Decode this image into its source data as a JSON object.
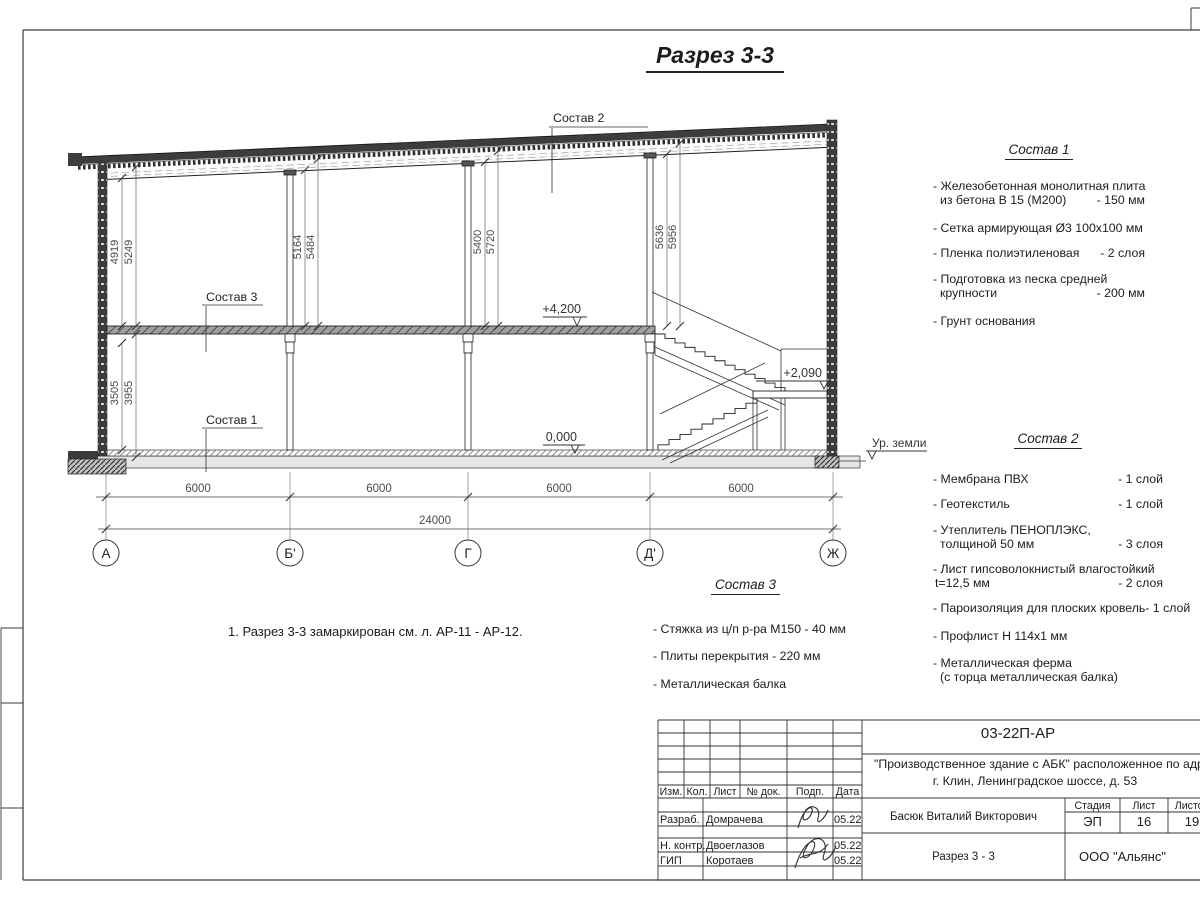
{
  "page": {
    "title": "Разрез 3-3",
    "note": "1. Разрез 3-3 замаркирован см. л. АР-11 - АР-12."
  },
  "drawing": {
    "callouts": {
      "s1": "Состав 1",
      "s2": "Состав 2",
      "s3": "Состав 3"
    },
    "levels": {
      "floor2": "+4,200",
      "floor1": "0,000",
      "landing": "+2,090",
      "ground": "Ур. земли"
    },
    "dims_upper": [
      [
        "4919",
        "5249"
      ],
      [
        "5164",
        "5484"
      ],
      [
        "5400",
        "5720"
      ],
      [
        "5636",
        "5956"
      ]
    ],
    "dims_lower": [
      "3505",
      "3955"
    ],
    "spans": [
      "6000",
      "6000",
      "6000",
      "6000"
    ],
    "total": "24000",
    "axes": [
      "А",
      "Б'",
      "Г",
      "Д'",
      "Ж"
    ]
  },
  "s1": {
    "title": "Состав 1",
    "i1a": "- Железобетонная  монолитная плита",
    "i1b": "из бетона В 15 (М200)",
    "i1v": "- 150 мм",
    "i2": "- Сетка армирующая Ø3 100х100 мм",
    "i3": "- Пленка полиэтиленовая",
    "i3v": "-  2 слоя",
    "i4a": "- Подготовка из песка средней",
    "i4b": "крупности",
    "i4v": "- 200 мм",
    "i5": "- Грунт основания"
  },
  "s2": {
    "title": "Состав 2",
    "i1": "- Мембрана ПВХ",
    "i1v": "- 1 слой",
    "i2": "- Геотекстиль",
    "i2v": "- 1 слой",
    "i3a": "- Утеплитель ПЕНОПЛЭКС,",
    "i3b": "толщиной 50 мм",
    "i3v": "- 3 слоя",
    "i4a": "- Лист гипсоволокнистый влагостойкий",
    "i4b": "t=12,5 мм",
    "i4v": "- 2 слоя",
    "i5": "- Пароизоляция для плоских кровель",
    "i5v": "- 1 слой",
    "i6": "- Профлист Н 114х1 мм",
    "i7a": "- Металлическая ферма",
    "i7b": "(с торца металлическая балка)"
  },
  "s3": {
    "title": "Состав 3",
    "i1": "- Стяжка из ц/п р-ра М150 - 40 мм",
    "i2": "- Плиты перекрытия - 220 мм",
    "i3": "- Металлическая балка"
  },
  "tb": {
    "code": "03-22П-АР",
    "project_line1": "\"Производственное здание с АБК\" расположенное по адресу:",
    "project_line2": "г. Клин, Ленинградское шоссе, д. 53",
    "cols": [
      "Изм.",
      "Кол.",
      "Лист",
      "№ док.",
      "Подп.",
      "Дата"
    ],
    "rows": [
      {
        "role": "Разраб.",
        "name": "Домрачева",
        "date": "05.22"
      },
      {
        "role": "Н. контр.",
        "name": "Двоеглазов",
        "date": "05.22"
      },
      {
        "role": "ГИП",
        "name": "Коротаев",
        "date": "05.22"
      }
    ],
    "approver": "Басюк Виталий Викторович",
    "stage_label": "Стадия",
    "sheet_label": "Лист",
    "sheets_label": "Листов",
    "stage": "ЭП",
    "sheet": "16",
    "sheets": "19",
    "drawing_name": "Разрез 3 - 3",
    "company": "ООО \"Альянс\""
  }
}
